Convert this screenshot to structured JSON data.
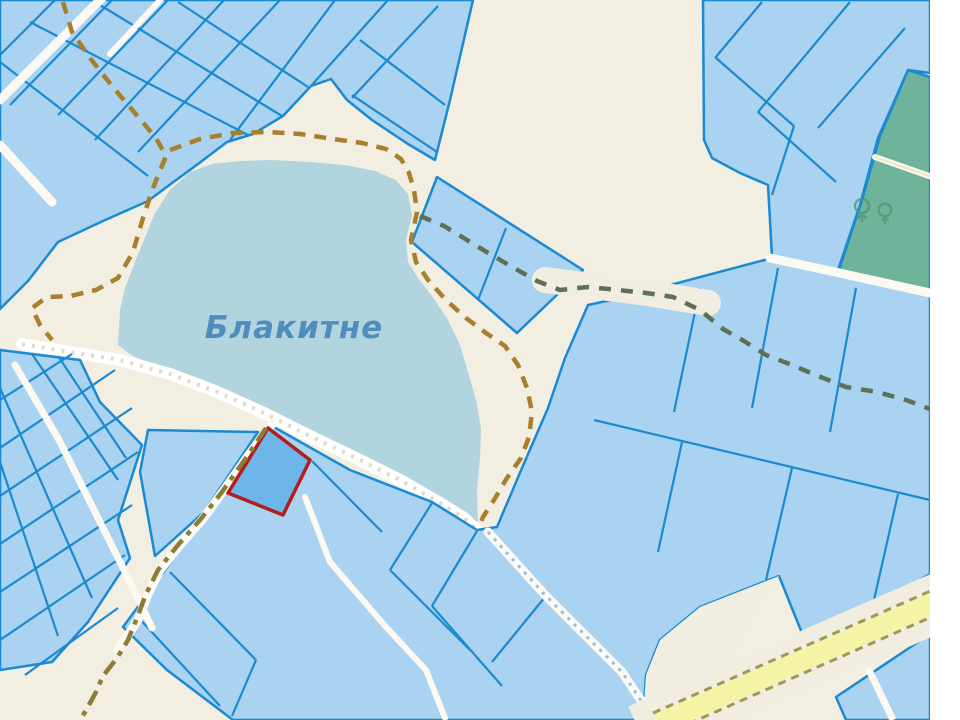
{
  "map": {
    "lake_label": "Блакитне"
  },
  "icons": {
    "forest": "tree-icon"
  },
  "colors": {
    "background": "#f2eee1",
    "water": "#b2d4de",
    "water_label": "#4e8dbe",
    "parcel_fill": "#a9d3f0",
    "parcel_stroke": "#1a8ad2",
    "selected_fill": "#6db6ea",
    "selected_stroke": "#b51d1d",
    "forest_fill": "#6fb39b",
    "forest_icon": "#4f9479",
    "road_white": "#fbf9f2",
    "road_cream": "#f1ede1",
    "road_yellow": "#f3f4a4",
    "road_yellow_edge": "#9c9c50",
    "road_slope_dash": "#8fc0e4",
    "trail_brown": "#a8802c",
    "trail_olive": "#5f7055",
    "trail_gold": "#8c7c38",
    "beach": "#ffffff",
    "beach_texture": "#dedacc",
    "margin": "#ffffff"
  }
}
